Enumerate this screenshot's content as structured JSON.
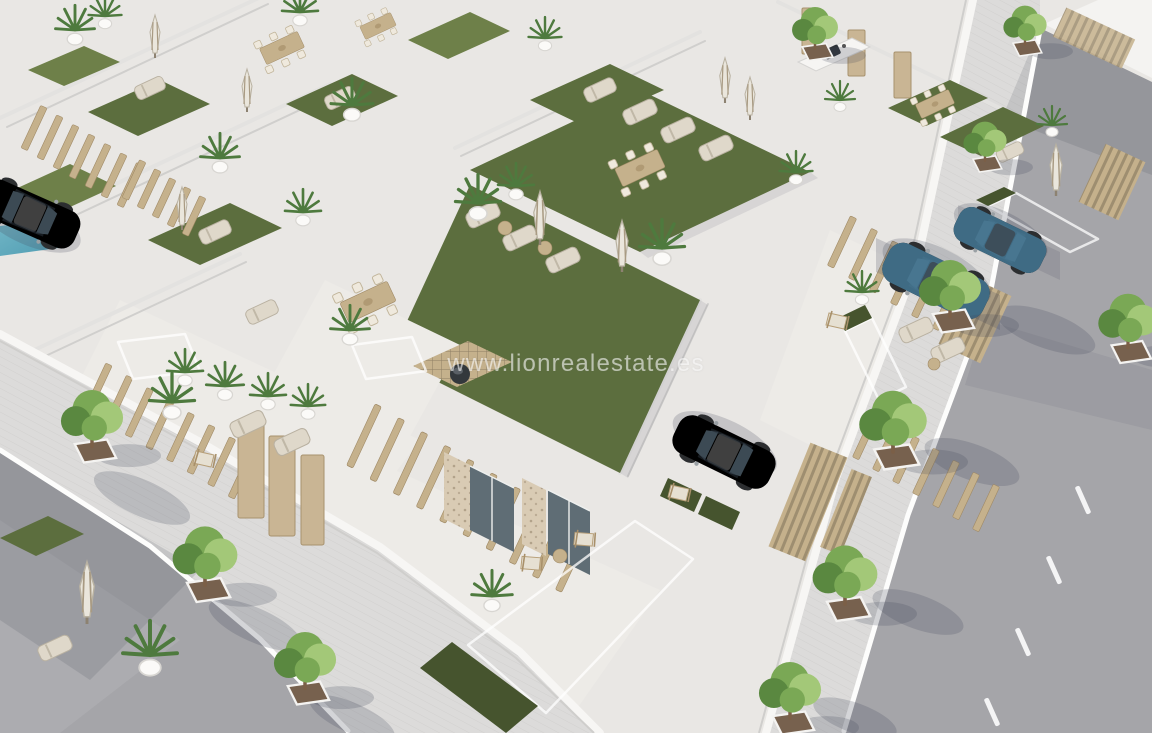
{
  "meta": {
    "type": "aerial-3d-architectural-render",
    "subject": "New-build development of modern white villas with rooftop turf terraces, private pools, parked cars and tree-lined streets, viewed from above at an angle"
  },
  "watermark": {
    "text": "www.lionrealestate.es"
  },
  "palette": {
    "ground": "#e9e7e4",
    "courtyard": "#edebe7",
    "asphalt": "#a5a5a9",
    "asphalt_light": "#b4b4b7",
    "road_shadow": "rgba(60,65,80,0.15)",
    "sidewalk": "#dcdbda",
    "paver": "#c9c8c6",
    "curb": "#fdfdfc",
    "wall_shade": "#e3e2e0",
    "wall_edge": "#cfcecc",
    "turf": "#5c6e3e",
    "turf_light": "#6e8049",
    "turf_dark": "#46542e",
    "pool_teal": "#8fb9bf",
    "pool_deep": "#5f909c",
    "pool_bright": "#72b6c6",
    "pool_bright_deep": "#4f9cb2",
    "pool_pale": "#a5c2b4",
    "wood": "#c5b18c",
    "wood_dark": "#a08a66",
    "door_wood": "#c9b594",
    "stone": "#d9cbb4",
    "glass": "#5f6d75",
    "tree_light": "#a3c878",
    "tree_mid": "#7aa855",
    "tree_dark": "#5a8840",
    "palm_green": "#4e7a3e",
    "soil": "#77614e",
    "trunk": "#7b5f47",
    "car_blue": "#4a7e9b",
    "car_blue_dark": "#2e4f63",
    "car_white": "#ecedec",
    "car_glass": "#3c4a54",
    "furniture_beige": "#dfd8ca",
    "furniture_frame": "#b9b1a1",
    "shadow": "rgba(70,75,90,0.22)",
    "watermark": "rgba(255,255,255,0.58)"
  },
  "scene": {
    "buildings": "white flat-roofed villas in diagonal rows",
    "roof_gardens": "artificial-turf roof terraces with sun loungers, furled striped parasols, potted palms, wooden dining sets and a timber fire-pit deck",
    "pools_visible": 6,
    "vehicles": {
      "white_cars": 2,
      "blue_suvs": 2
    },
    "streets": {
      "lower_left": "asphalt road with paver sidewalk and young trees in square planters",
      "right": "asphalt road with dashed white lane markings and tree-lined paver sidewalk"
    },
    "street_trees": 8,
    "stairs": "open timber-slat staircases connecting courtyards to roof terraces"
  }
}
